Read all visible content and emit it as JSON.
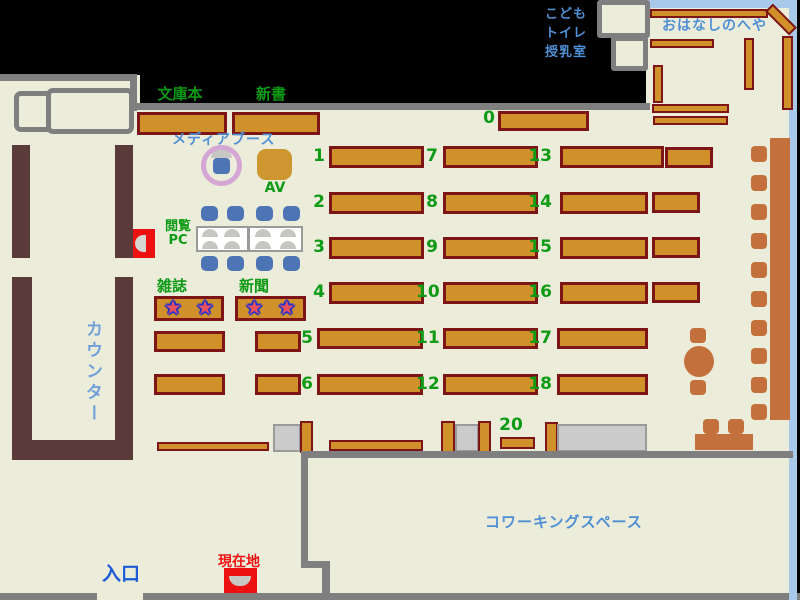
{
  "colors": {
    "floor": "#ececdb",
    "wall_gray": "#7f7f7f",
    "shelf_fill": "#d0912b",
    "shelf_border": "#7d1416",
    "counter_brown": "#5b3a3a",
    "terracotta": "#c3703d",
    "chair_blue": "#4d74b5",
    "ring_pink": "#d4a6d4",
    "room_border_blue": "#a9c9ea",
    "accent_red": "#ee1111",
    "label_green": "#0d9a14",
    "label_blue": "#4f8fd4",
    "counter_text": "#6f9fd8",
    "entrance_blue": "#1e5bd6"
  },
  "labels": {
    "bunkobon": "文庫本",
    "shinsho": "新書",
    "media_booth": "メディアブース",
    "av": "AV",
    "reading1": "閲覧",
    "reading2": "PC",
    "zasshi": "雑誌",
    "shinbun": "新聞",
    "counter": "カウンター",
    "kodomo1": "こども",
    "kodomo2": "トイレ",
    "kodomo3": "授乳室",
    "ohanashi": "おはなしのへや",
    "coworking": "コワーキングスペース",
    "entrance": "入口",
    "current_location": "現在地",
    "star": "★"
  },
  "numbers": {
    "n0": "0",
    "n1": "1",
    "n2": "2",
    "n3": "3",
    "n4": "4",
    "n5": "5",
    "n6": "6",
    "n7": "7",
    "n8": "8",
    "n9": "9",
    "n10": "10",
    "n11": "11",
    "n12": "12",
    "n13": "13",
    "n14": "14",
    "n15": "15",
    "n16": "16",
    "n17": "17",
    "n18": "18",
    "n20": "20"
  }
}
